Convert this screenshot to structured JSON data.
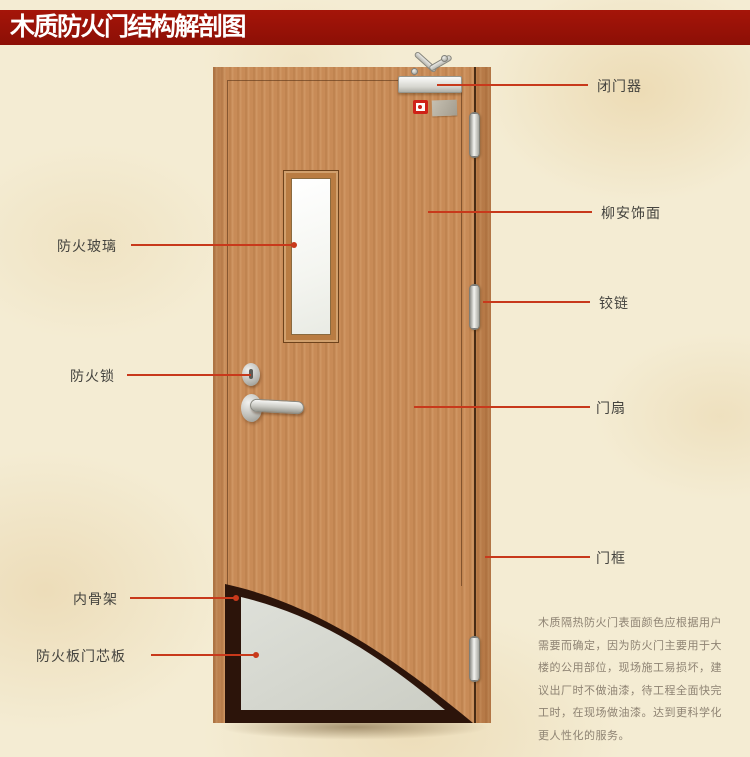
{
  "header": {
    "title": "木质防火门结构解剖图"
  },
  "annotations": {
    "left": [
      {
        "label": "防火玻璃"
      },
      {
        "label": "防火锁"
      },
      {
        "label": "内骨架"
      },
      {
        "label": "防火板门芯板"
      }
    ],
    "right": [
      {
        "label": "闭门器"
      },
      {
        "label": "柳安饰面"
      },
      {
        "label": "铰链"
      },
      {
        "label": "门扇"
      },
      {
        "label": "门框"
      }
    ]
  },
  "description": {
    "lines": [
      "木质隔热防火门表面颜色应根据用户",
      "需要而确定，因为防火门主要用于大",
      "楼的公用部位，现场施工易损坏，建",
      "议出厂时不做油漆，待工程全面快完",
      "工时，在现场做油漆。达到更科学化",
      "更人性化的服务。"
    ]
  },
  "colors": {
    "header_bg": "#9a120b",
    "header_text": "#ffffff",
    "background": "#f4ecd3",
    "leader_line": "#c8391b",
    "door_wood": "#c88b57",
    "core_panel": "#d8dad2",
    "inner_skeleton": "#2c140a",
    "label_text": "#45443f",
    "description_text": "#8e8373"
  }
}
